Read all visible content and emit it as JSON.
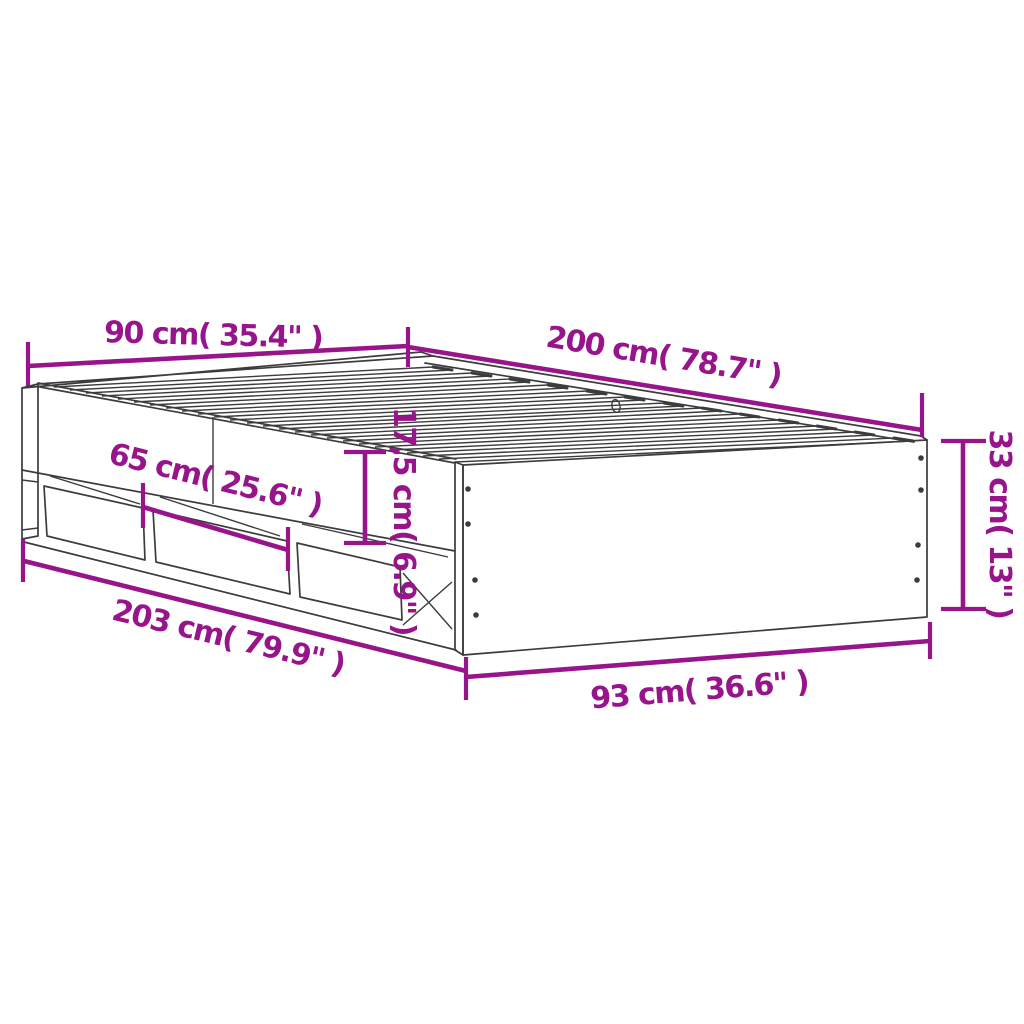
{
  "diagram": {
    "subject": "bed-frame-with-drawers-dimension-diagram",
    "dimensions": {
      "head_width": "90 cm( 35.4\" )",
      "top_length": "200 cm( 78.7\" )",
      "drawer_width": "65 cm( 25.6\" )",
      "drawer_height": "17,5 cm( 6.9\" )",
      "frame_height": "33 cm( 13\" )",
      "base_length": "203 cm( 79.9\" )",
      "foot_width": "93 cm( 36.6\" )"
    },
    "colors": {
      "dimension": "#97148B",
      "outline": "#3C3C3C",
      "background": "#FFFFFF"
    }
  }
}
